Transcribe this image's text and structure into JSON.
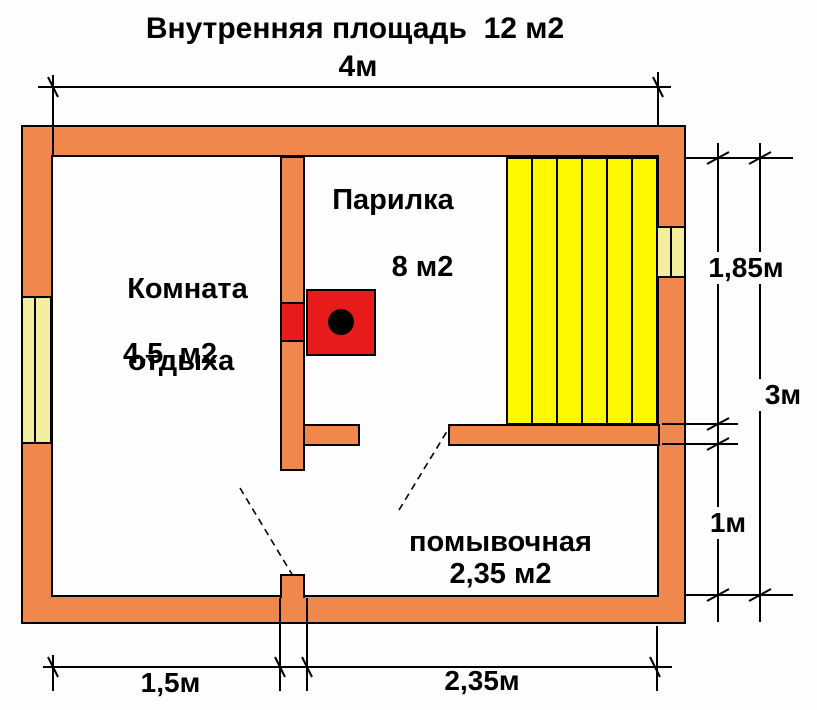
{
  "title": "Внутренняя площадь  12 м2",
  "rooms": {
    "rest": {
      "name_line1": "Комната",
      "name_line2": "отдыха",
      "area": "4,5  м2"
    },
    "steam": {
      "name": "Парилка",
      "area": "8 м2"
    },
    "wash": {
      "name": "помывочная",
      "area": "2,35 м2"
    }
  },
  "dimensions": {
    "width_total": "4м",
    "steam_depth": "1,85м",
    "height_total": "3м",
    "wash_depth": "1м",
    "entry_left": "1,5м",
    "entry_right": "2,35м"
  },
  "colors": {
    "wall": "#F0874D",
    "stove": "#E81B1B",
    "bench": "#FFF800",
    "window": "#F3EE9C",
    "outline": "#000000",
    "bg": "#FDFDFD",
    "text": "#000000"
  }
}
